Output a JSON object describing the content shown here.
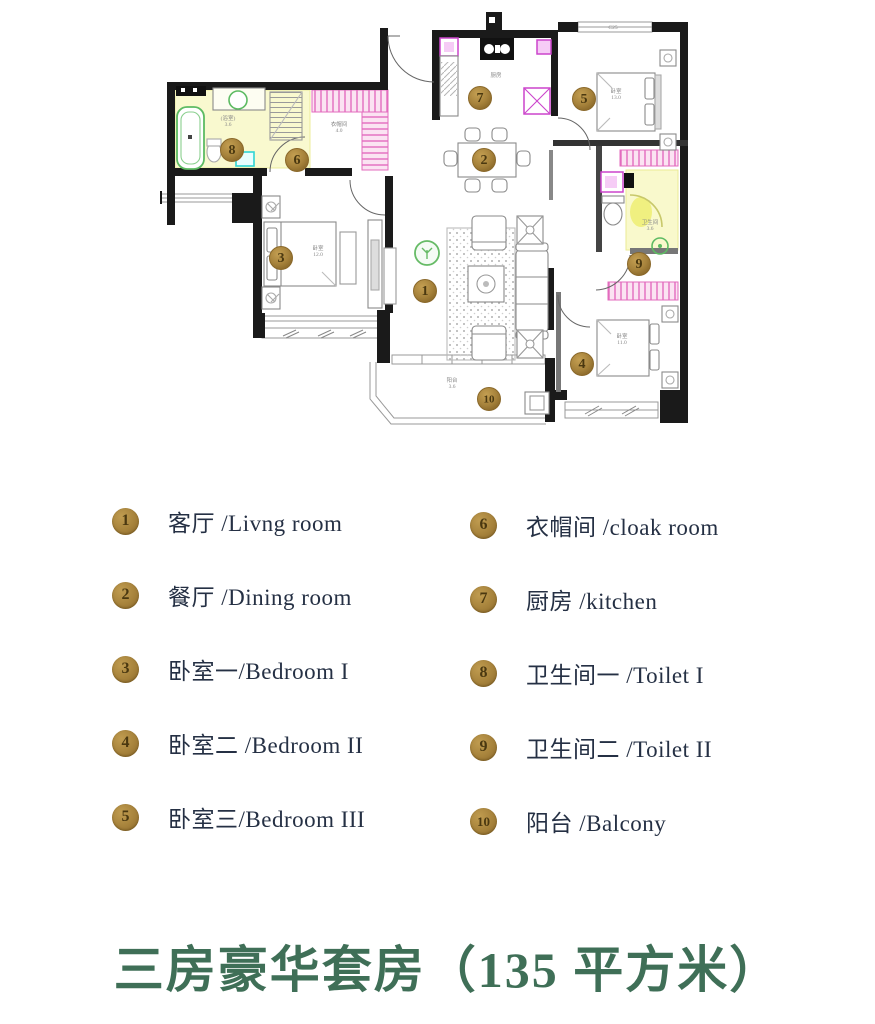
{
  "title": "三房豪华套房（135 平方米）",
  "legend": {
    "items": [
      {
        "num": "1",
        "label": "客厅 /Livng room"
      },
      {
        "num": "2",
        "label": "餐厅 /Dining room"
      },
      {
        "num": "3",
        "label": "卧室一/Bedroom I"
      },
      {
        "num": "4",
        "label": "卧室二 /Bedroom II"
      },
      {
        "num": "5",
        "label": "卧室三/Bedroom III"
      },
      {
        "num": "6",
        "label": "衣帽间 /cloak room"
      },
      {
        "num": "7",
        "label": "厨房 /kitchen"
      },
      {
        "num": "8",
        "label": "卫生间一 /Toilet I"
      },
      {
        "num": "9",
        "label": "卫生间二 /Toilet II"
      },
      {
        "num": "10",
        "label": "阳台 /Balcony"
      }
    ]
  },
  "floor_plan": {
    "markers": [
      {
        "num": "1",
        "x": 425,
        "y": 291
      },
      {
        "num": "2",
        "x": 484,
        "y": 160
      },
      {
        "num": "3",
        "x": 281,
        "y": 258
      },
      {
        "num": "4",
        "x": 582,
        "y": 364
      },
      {
        "num": "5",
        "x": 584,
        "y": 99
      },
      {
        "num": "6",
        "x": 297,
        "y": 160
      },
      {
        "num": "7",
        "x": 480,
        "y": 98
      },
      {
        "num": "8",
        "x": 232,
        "y": 150
      },
      {
        "num": "9",
        "x": 639,
        "y": 264
      },
      {
        "num": "10",
        "x": 489,
        "y": 399
      }
    ],
    "area_labels": [
      {
        "lines": [
          "(浴室)",
          "3.6"
        ],
        "x": 228,
        "y": 120
      },
      {
        "lines": [
          "衣帽间",
          "4.0"
        ],
        "x": 339,
        "y": 126
      },
      {
        "lines": [
          "厨房"
        ],
        "x": 496,
        "y": 77
      },
      {
        "lines": [
          "C25"
        ],
        "x": 613,
        "y": 29
      },
      {
        "lines": [
          "卧室",
          "13.0"
        ],
        "x": 616,
        "y": 93
      },
      {
        "lines": [
          "卫生间",
          "3.6"
        ],
        "x": 650,
        "y": 224
      },
      {
        "lines": [
          "卧室",
          "12.0"
        ],
        "x": 318,
        "y": 250
      },
      {
        "lines": [
          "卧室",
          "11.0"
        ],
        "x": 622,
        "y": 338
      },
      {
        "lines": [
          "阳台",
          "3.6"
        ],
        "x": 452,
        "y": 382
      }
    ]
  },
  "colors": {
    "marker_gold": "#a6823b",
    "marker_number": "#4a3810",
    "title_green": "#3f6f57",
    "legend_text": "#253044",
    "wall_black": "#1a1a1a",
    "toilet_yellow": "#f8f8c0",
    "wardrobe_pink": "#e36bbe",
    "fixture_green": "#5dbb63",
    "appliance_magenta": "#cc44cc",
    "fixture_cyan": "#2fd4d4"
  }
}
